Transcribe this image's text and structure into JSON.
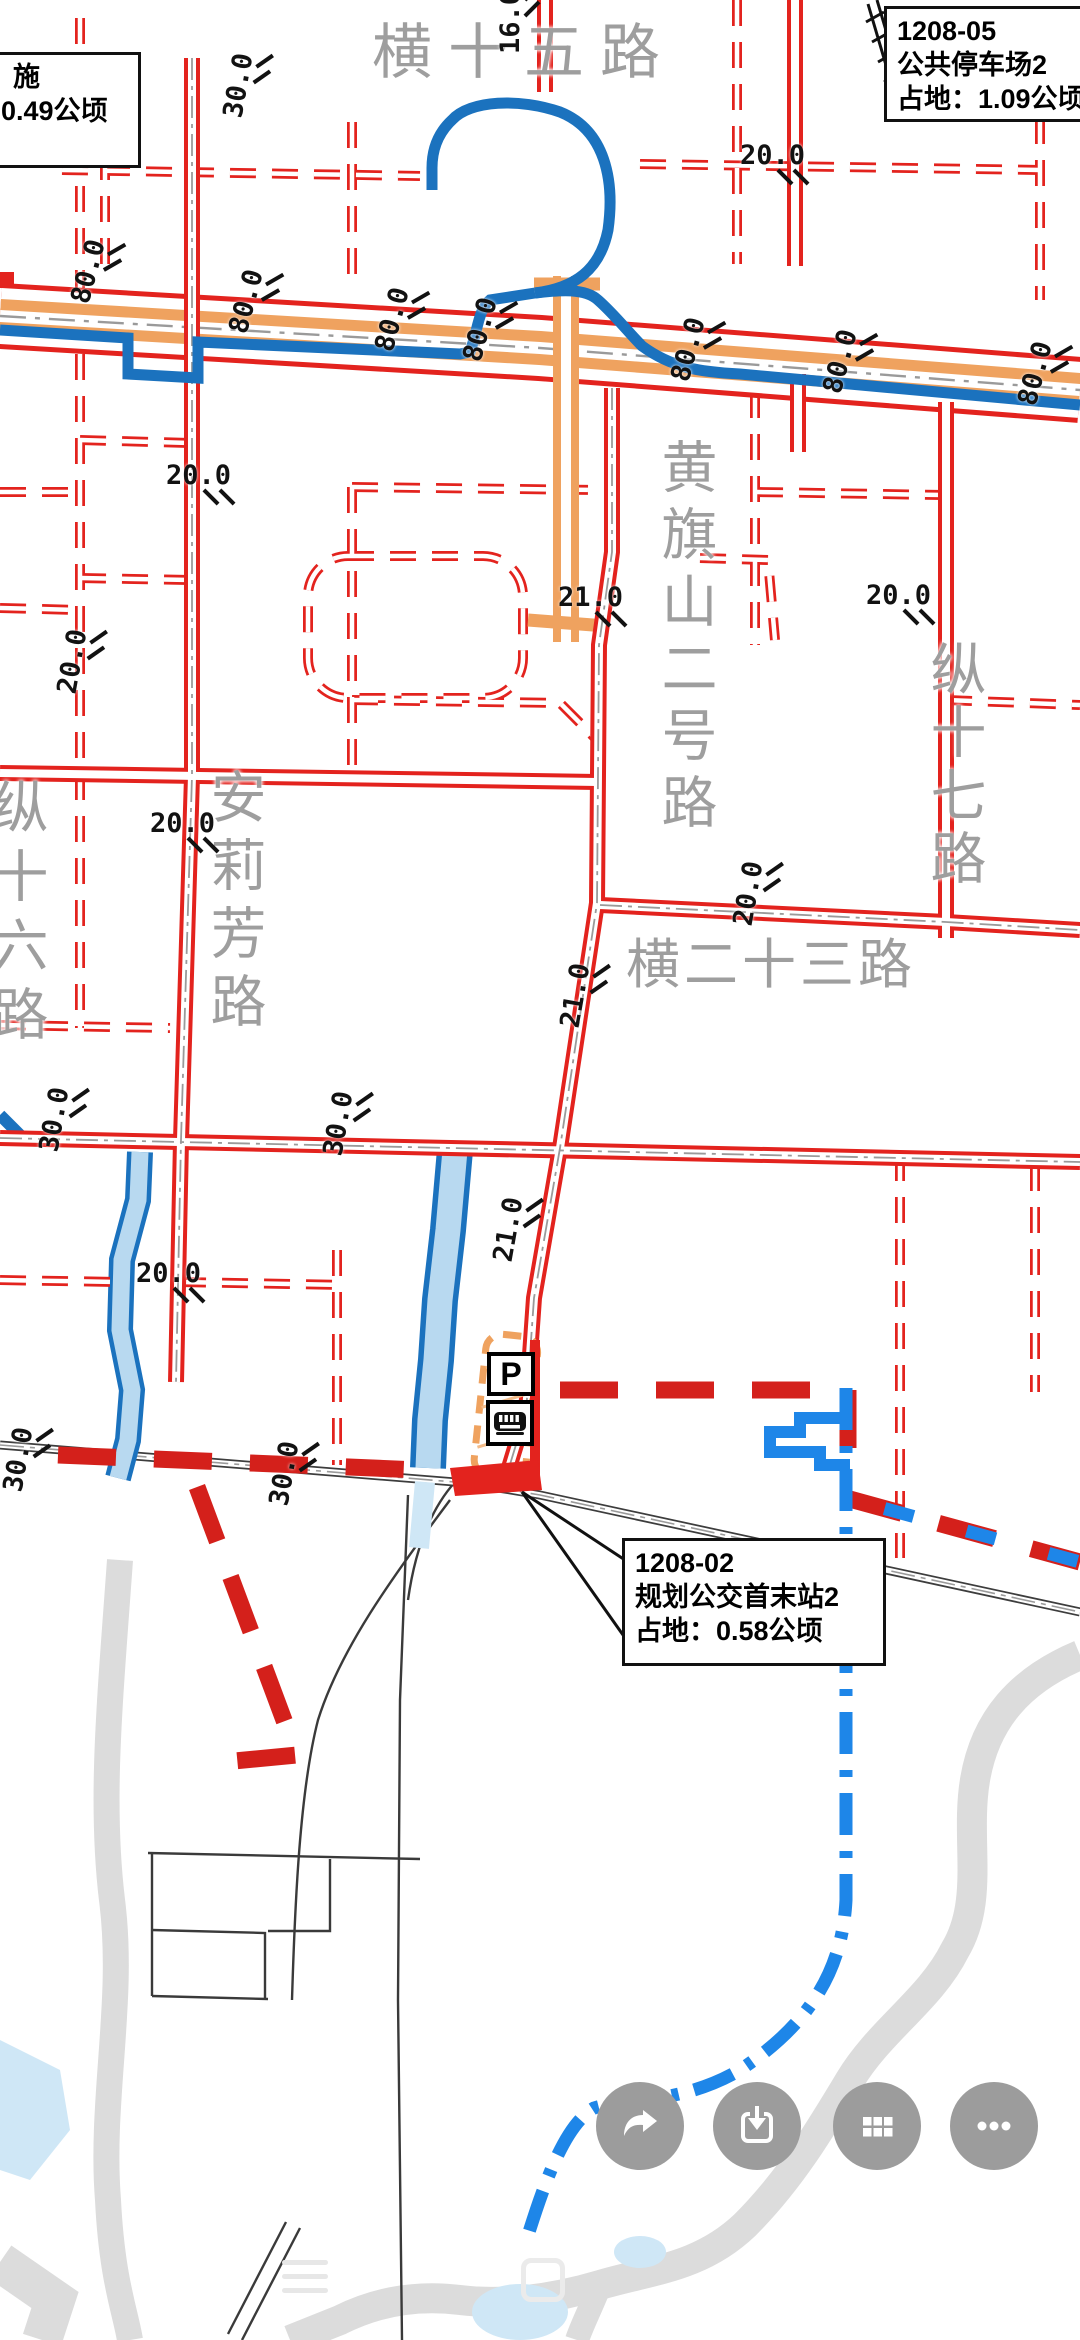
{
  "map": {
    "road_labels": [
      {
        "text": "横十五路",
        "x": 372,
        "y": 4,
        "size": 60,
        "ls": 16,
        "vertical": false
      },
      {
        "text": "黄旗山二号路",
        "x": 645,
        "y": 438,
        "size": 56,
        "ls": 11,
        "vertical": true
      },
      {
        "text": "纵十七路",
        "x": 914,
        "y": 640,
        "size": 56,
        "ls": 7,
        "vertical": true
      },
      {
        "text": "安莉芳路",
        "x": 194,
        "y": 768,
        "size": 56,
        "ls": 12,
        "vertical": true
      },
      {
        "text": "纵十六路",
        "x": -24,
        "y": 778,
        "size": 56,
        "ls": 13,
        "vertical": true
      },
      {
        "text": "横二十三路",
        "x": 626,
        "y": 920,
        "size": 54,
        "ls": 4,
        "vertical": false
      }
    ],
    "dimension_labels": [
      {
        "t": "16.0",
        "x": 478,
        "y": 6,
        "r": -90
      },
      {
        "t": "30.0",
        "x": 206,
        "y": 70,
        "r": -80
      },
      {
        "t": "20.0",
        "x": 740,
        "y": 140,
        "r": 0
      },
      {
        "t": "80.0",
        "x": 56,
        "y": 256,
        "r": -75
      },
      {
        "t": "80.0",
        "x": 214,
        "y": 286,
        "r": -75
      },
      {
        "t": "80.0",
        "x": 360,
        "y": 304,
        "r": -75
      },
      {
        "t": "80.0",
        "x": 448,
        "y": 314,
        "r": -75
      },
      {
        "t": "80.0",
        "x": 656,
        "y": 334,
        "r": -75
      },
      {
        "t": "80.0",
        "x": 808,
        "y": 346,
        "r": -75
      },
      {
        "t": "80.0",
        "x": 1003,
        "y": 358,
        "r": -75
      },
      {
        "t": "20.0",
        "x": 166,
        "y": 460,
        "r": 0
      },
      {
        "t": "21.0",
        "x": 558,
        "y": 582,
        "r": 0
      },
      {
        "t": "20.0",
        "x": 866,
        "y": 580,
        "r": 0
      },
      {
        "t": "20.0",
        "x": 40,
        "y": 646,
        "r": -80
      },
      {
        "t": "20.0",
        "x": 150,
        "y": 808,
        "r": 0
      },
      {
        "t": "20.0",
        "x": 716,
        "y": 878,
        "r": -80
      },
      {
        "t": "21.0",
        "x": 543,
        "y": 980,
        "r": -80
      },
      {
        "t": "30.0",
        "x": 22,
        "y": 1104,
        "r": -80
      },
      {
        "t": "30.0",
        "x": 306,
        "y": 1108,
        "r": -80
      },
      {
        "t": "21.0",
        "x": 476,
        "y": 1214,
        "r": -80
      },
      {
        "t": "20.0",
        "x": 136,
        "y": 1258,
        "r": 0
      },
      {
        "t": "30.0",
        "x": -14,
        "y": 1444,
        "r": -80
      },
      {
        "t": "30.0",
        "x": 252,
        "y": 1458,
        "r": -80
      }
    ],
    "callouts": {
      "parking": {
        "line1": "1208-05",
        "line2": "公共停车场2",
        "line3": "占地：1.09公顷"
      },
      "bus": {
        "line1": "1208-02",
        "line2": "规划公交首末站2",
        "line3": "占地：0.58公顷"
      },
      "partial": {
        "line1": "施",
        "line2": "0.49公顷"
      }
    },
    "parking_icon_letter": "P"
  },
  "toolbar": {
    "buttons": [
      {
        "name": "share"
      },
      {
        "name": "download"
      },
      {
        "name": "grid"
      },
      {
        "name": "more"
      }
    ]
  },
  "colors": {
    "road_red": "#e3231e",
    "arterial_orange": "#efa25f",
    "line_blue": "#1b72be",
    "water_fill": "#b8d9f0",
    "boundary_red": "#d4201b",
    "boundary_blue": "#1e86e8",
    "river_gray": "#dcdcdc",
    "label_gray": "#9e9e9e",
    "button_gray": "#9c9c9c"
  }
}
